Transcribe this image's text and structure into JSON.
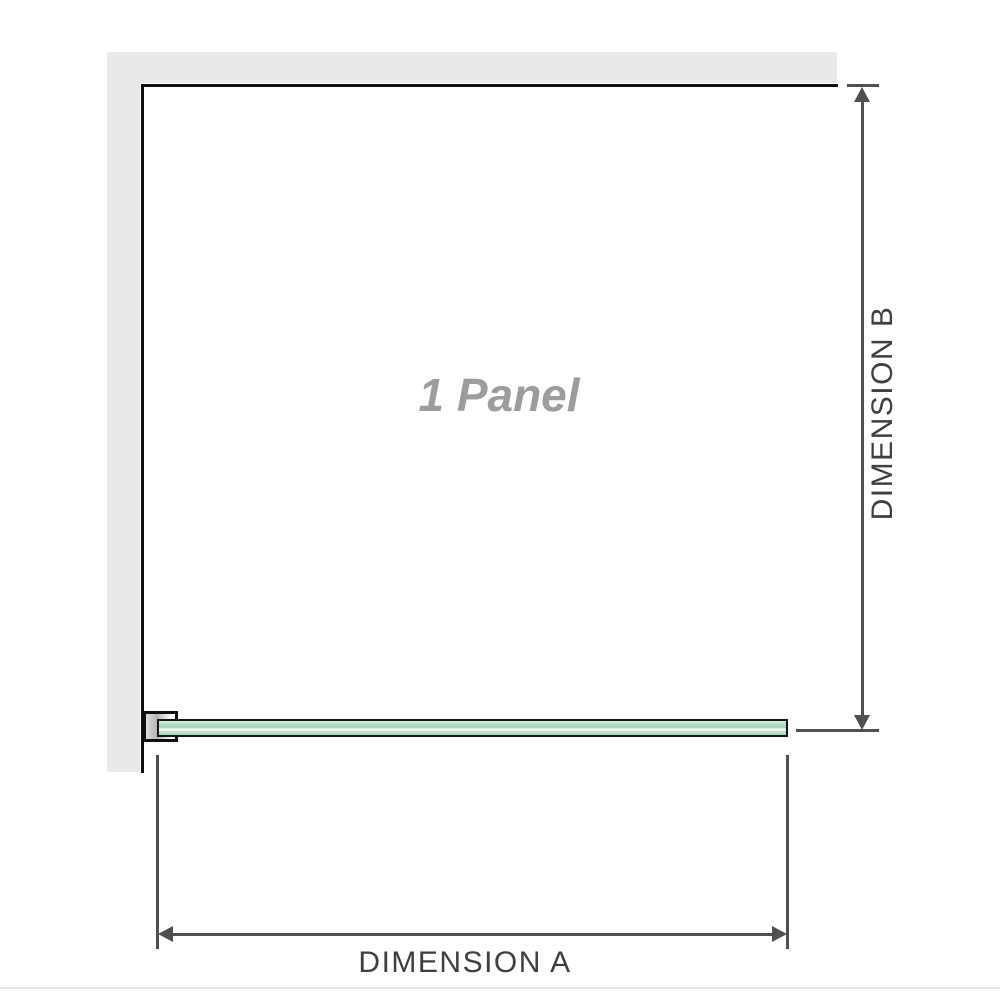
{
  "diagram": {
    "panel_label": "1 Panel",
    "dimension_a_label": "DIMENSION A",
    "dimension_b_label": "DIMENSION B"
  },
  "colors": {
    "wall_fill": "#e9e9e9",
    "wall_edge": "#0f0f0f",
    "dim_line": "#4f4f4f",
    "dim_label": "#3f3f3f",
    "glass_border": "#161616",
    "glass_green": "#9fd3b3",
    "glass_green_light": "#dcefe4",
    "glass_highlight": "#f6fbf8",
    "bracket_gray": "#b5b5b5",
    "panel_label_color": "#9c9c9c",
    "baseline_color": "#e8e6df"
  }
}
